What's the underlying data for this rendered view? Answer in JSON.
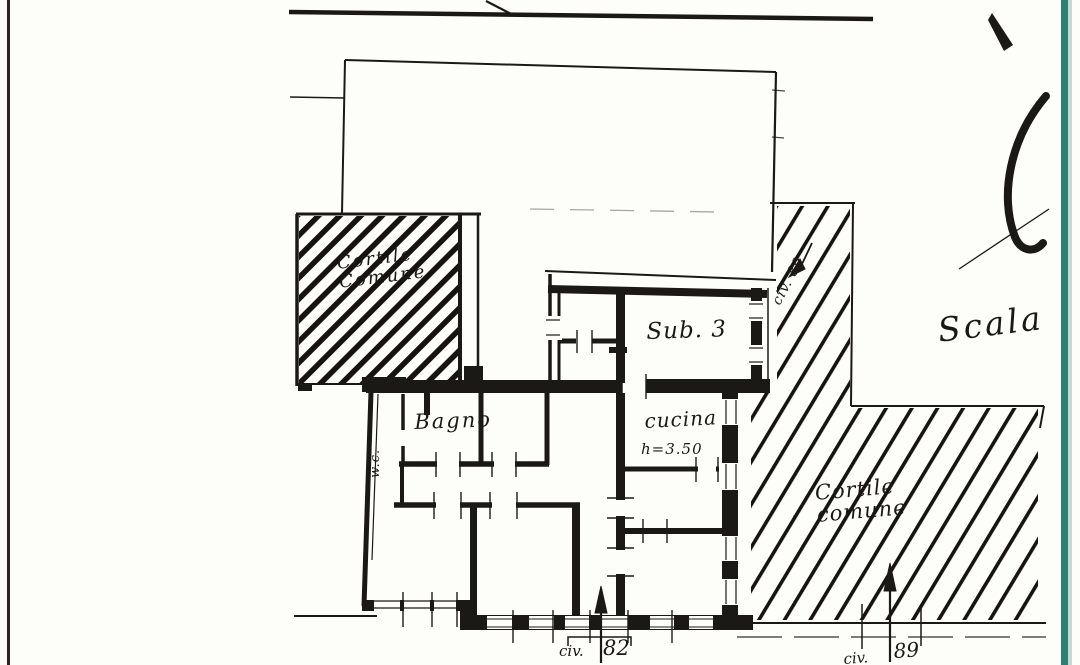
{
  "plan": {
    "rooms": {
      "courtyard_top_left": {
        "line1": "Cortile",
        "line2": "Comune"
      },
      "sub3": {
        "label": "Sub. 3"
      },
      "bagno": {
        "label": "Bagno"
      },
      "wc": {
        "label": "w.c."
      },
      "cucina": {
        "label": "cucina",
        "height_note": "h=3.50"
      },
      "courtyard_right": {
        "line1": "Cortile",
        "line2": "comune"
      }
    },
    "annotations": {
      "scala": "Scala",
      "civ82": {
        "prefix": "civ.",
        "number": "82"
      },
      "civ89": {
        "prefix": "civ.",
        "number": "89"
      },
      "strip_civ89": "civ. 89"
    },
    "colors": {
      "ink": "#1b1915",
      "paper": "#fdfdfa",
      "left_edge_line": "#342220",
      "right_edge_line": "#2e7e71"
    }
  }
}
